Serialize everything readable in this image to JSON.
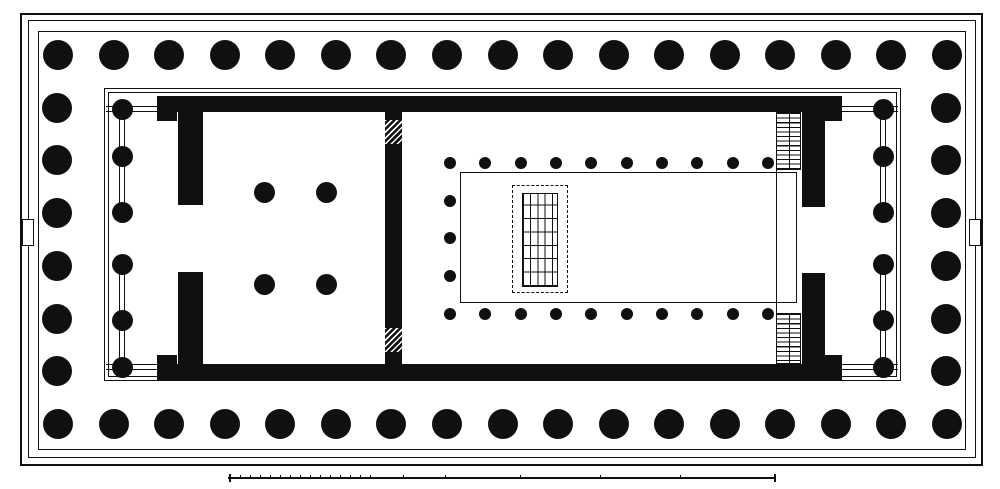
{
  "canvas": {
    "w": 1000,
    "h": 489,
    "paper": "#ffffff",
    "ink": "#101010"
  },
  "crepidoma": {
    "steps": [
      {
        "name": "crepidoma-step-outer",
        "x": 20,
        "y": 13,
        "w": 963,
        "h": 453,
        "stroke": 2
      },
      {
        "name": "crepidoma-step-middle",
        "x": 28,
        "y": 20,
        "w": 948,
        "h": 438,
        "stroke": 1.5
      },
      {
        "name": "stylobate-edge",
        "x": 38,
        "y": 31,
        "w": 928,
        "h": 419,
        "stroke": 1.8
      }
    ],
    "side_tabs": [
      {
        "name": "west-side-tab",
        "x": 22,
        "y": 219,
        "w": 12,
        "h": 27
      },
      {
        "name": "east-side-tab",
        "x": 969,
        "y": 219,
        "w": 12,
        "h": 27
      }
    ]
  },
  "peristyle": {
    "radius": 15,
    "top": {
      "y": 55,
      "x1": 58,
      "x2": 947,
      "n": 17
    },
    "bottom": {
      "y": 424,
      "x1": 58,
      "x2": 947,
      "n": 17
    },
    "left": {
      "x": 57,
      "y1": 55,
      "y2": 424,
      "n": 8
    },
    "right": {
      "x": 946,
      "y1": 55,
      "y2": 424,
      "n": 8
    }
  },
  "naos_platform": [
    {
      "name": "naos-platform-outer",
      "x": 104,
      "y": 88,
      "w": 797,
      "h": 293,
      "stroke": 1.3
    },
    {
      "name": "naos-platform-inner",
      "x": 108,
      "y": 92,
      "w": 789,
      "h": 285,
      "stroke": 1.1
    }
  ],
  "walls": [
    {
      "name": "north-cella-wall",
      "x": 157,
      "y": 96,
      "w": 685,
      "h": 16
    },
    {
      "name": "south-cella-wall",
      "x": 157,
      "y": 364,
      "w": 685,
      "h": 16
    },
    {
      "name": "west-crosswall-upper",
      "x": 178,
      "y": 96,
      "w": 25,
      "h": 109
    },
    {
      "name": "west-crosswall-lower",
      "x": 178,
      "y": 272,
      "w": 25,
      "h": 108
    },
    {
      "name": "mid-crosswall",
      "x": 385,
      "y": 112,
      "w": 17,
      "h": 252
    },
    {
      "name": "east-crosswall-upper",
      "x": 802,
      "y": 112,
      "w": 23,
      "h": 95
    },
    {
      "name": "east-crosswall-lower",
      "x": 802,
      "y": 273,
      "w": 23,
      "h": 91
    },
    {
      "name": "anta-northwest",
      "x": 157,
      "y": 112,
      "w": 20,
      "h": 9
    },
    {
      "name": "anta-southwest",
      "x": 157,
      "y": 355,
      "w": 20,
      "h": 9
    },
    {
      "name": "anta-northeast",
      "x": 822,
      "y": 112,
      "w": 20,
      "h": 9
    },
    {
      "name": "anta-southeast",
      "x": 822,
      "y": 355,
      "w": 20,
      "h": 9
    }
  ],
  "wall_hatches": [
    {
      "name": "mid-wall-hatch-top",
      "x": 385,
      "y": 120,
      "w": 17,
      "h": 24
    },
    {
      "name": "mid-wall-hatch-bottom",
      "x": 385,
      "y": 328,
      "w": 17,
      "h": 24
    }
  ],
  "porches": {
    "radius": 10.5,
    "column_ys": [
      109,
      156,
      212,
      264,
      320,
      367
    ],
    "links": [
      [
        0,
        1
      ],
      [
        1,
        2
      ],
      [
        3,
        4
      ],
      [
        4,
        5
      ]
    ],
    "west": {
      "name": "west-porch",
      "x": 122,
      "rail_x1": 106,
      "rail_x2": 157
    },
    "east": {
      "name": "east-porch",
      "x": 883,
      "rail_x1": 842,
      "rail_x2": 898
    }
  },
  "west_chamber_columns": {
    "radius": 10.5,
    "points": [
      [
        264,
        192
      ],
      [
        326,
        192
      ],
      [
        264,
        284
      ],
      [
        326,
        284
      ]
    ]
  },
  "cella": {
    "inner_rect": {
      "name": "cella-floor-outline",
      "x": 460,
      "y": 172,
      "w": 337,
      "h": 131,
      "stroke": 1.2
    },
    "colonnade": {
      "radius": 6,
      "x1": 450,
      "x2": 768,
      "n": 10,
      "top_y": 163,
      "bottom_y": 314,
      "west_x": 450,
      "west_mid_ys": [
        201,
        238,
        276
      ]
    },
    "vestibule_line": {
      "name": "door-vestibule-line",
      "x": 776,
      "y1": 170,
      "y2": 313,
      "t": 1.1
    }
  },
  "statue_base": {
    "dashed": {
      "name": "statue-base-dashed-outline",
      "x": 512,
      "y": 185,
      "w": 56,
      "h": 108
    },
    "grid": {
      "name": "statue-base-pedestal-grid",
      "x": 522,
      "y": 193,
      "w": 36,
      "h": 94
    }
  },
  "stairs": [
    {
      "name": "north-staircase",
      "x": 776,
      "y": 112,
      "w": 25,
      "h": 58
    },
    {
      "name": "south-staircase",
      "x": 776,
      "y": 313,
      "w": 25,
      "h": 51
    }
  ],
  "scale_bar": {
    "name": "scale-bar",
    "y": 477,
    "x1": 228,
    "x2": 776,
    "dense_ticks": {
      "from": 240,
      "to": 370,
      "step": 10
    },
    "sparse_ticks": [
      403,
      445,
      520,
      600,
      680
    ],
    "end_bars": [
      229,
      774
    ]
  }
}
